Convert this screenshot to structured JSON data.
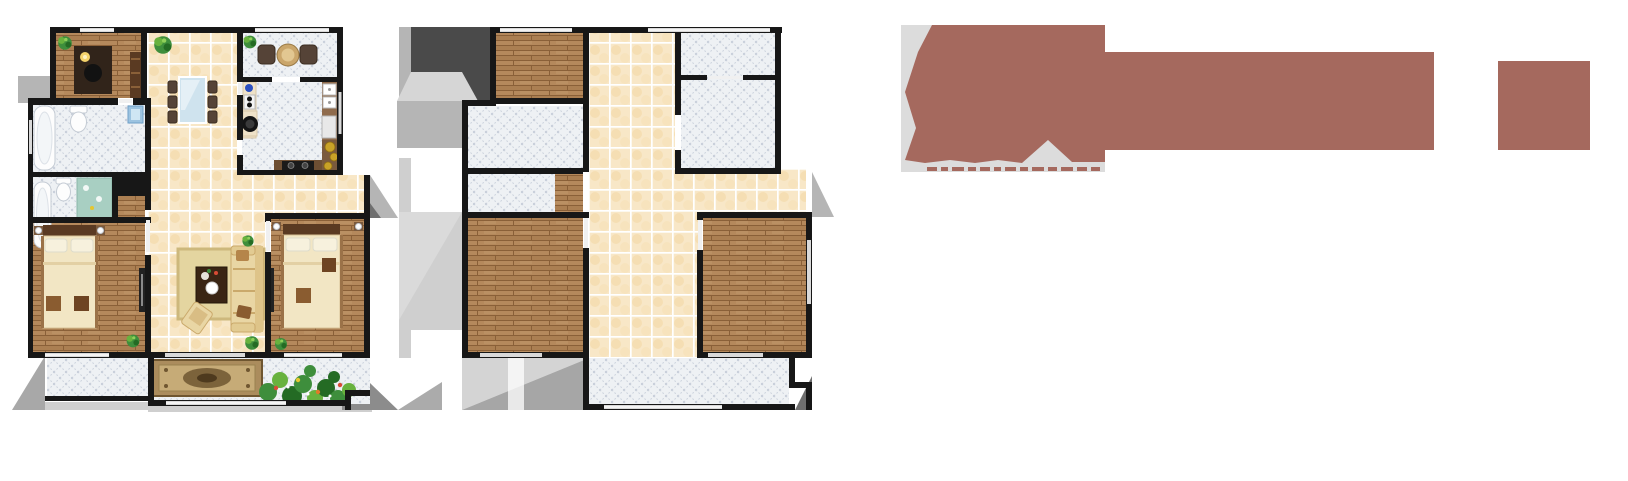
{
  "page": {
    "background": "#ffffff"
  },
  "palette": {
    "wall": "#171717",
    "wood": "#b1855a",
    "wood_line": "#8a6038",
    "wood_dark": "#9b7248",
    "cream": "#f8e7c7",
    "cream_spot": "#f1d7a2",
    "grout": "#ffffff",
    "diag": "#eef1f5",
    "diag_line": "#c5ccd8",
    "shadow_darkest": "#4a4a4a",
    "shadow_dark": "#8c8c8c",
    "shadow_mid": "#b5b5b5",
    "shadow_light": "#cfcfcf",
    "shadow_lighter": "#d9d9d9",
    "logo": "#a5695e",
    "logo_panel": "#dcdcdc",
    "fixture": "#fdfdfd",
    "fixture_line": "#c4cbd4",
    "counter": "#8f6b4c",
    "counter_dark": "#5a3a22",
    "appliance": "#1d1d1d",
    "glass": "#cfe3ee",
    "chair": "#554337",
    "sofa": "#e9d6a4",
    "sofa_shadow": "#caa96b",
    "rug": "#e4d5a0",
    "rug_border": "#cdb87c",
    "carpet": "#ab8c5d",
    "carpet_inner": "#c6ab77",
    "carpet_dark": "#6f5630",
    "bed": "#f2e6c4",
    "pillow": "#f7f1dd",
    "head": "#5a3a22",
    "plant": "#3e8e3c",
    "plant_light": "#68b23e",
    "plant_dark": "#246b24",
    "flower_red": "#d84b35",
    "flower_yellow": "#e5c62f",
    "flower_orange": "#e07b28",
    "gold": "#c9a227",
    "teal": "#a8cfc2",
    "sink_blue": "#9cc3e0"
  },
  "watermark": {
    "color": "#a5695e",
    "panel_color": "#dcdcdc"
  }
}
